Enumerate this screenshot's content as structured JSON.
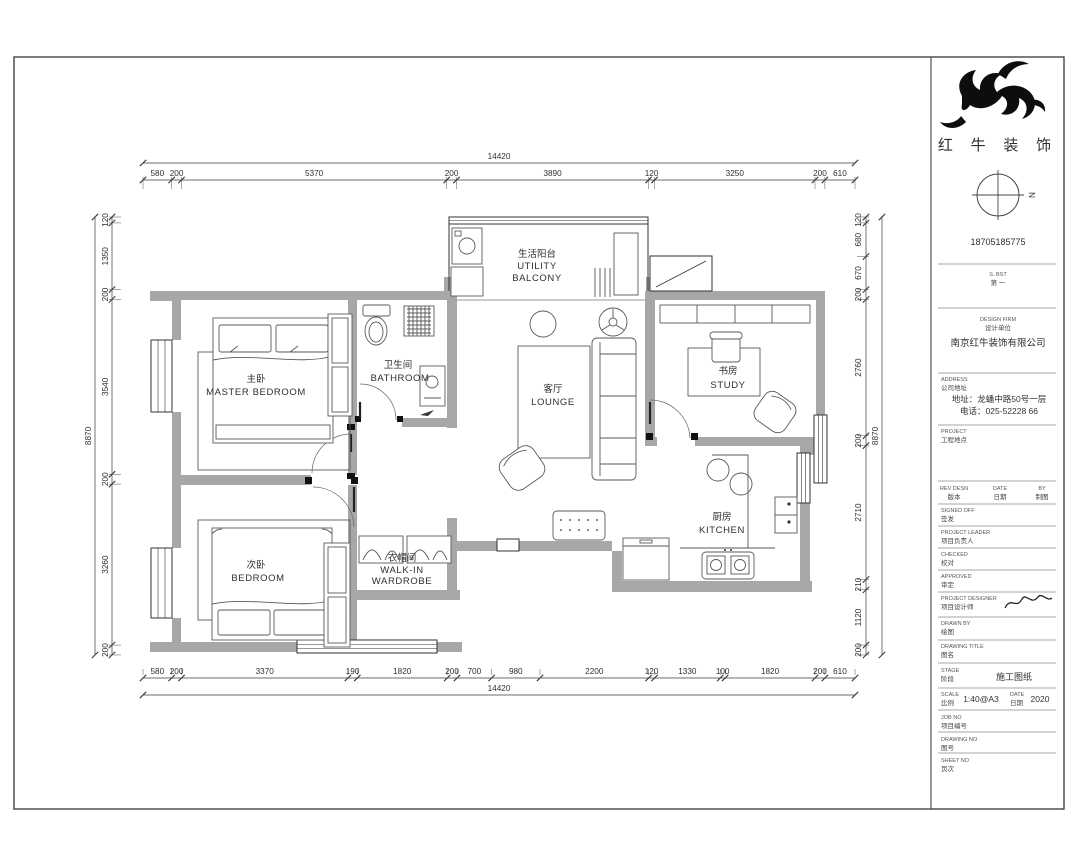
{
  "rooms": {
    "master": {
      "zh": "主卧",
      "en": "MASTER  BEDROOM"
    },
    "bedroom": {
      "zh": "次卧",
      "en": "BEDROOM"
    },
    "bathroom": {
      "zh": "卫生间",
      "en": "BATHROOM"
    },
    "wardrobe": {
      "zh": "衣帽间",
      "en": "WALK-IN",
      "en2": "WARDROBE"
    },
    "lounge": {
      "zh": "客厅",
      "en": "LOUNGE"
    },
    "balcony": {
      "zh": "生活阳台",
      "en": "UTILITY",
      "en2": "BALCONY"
    },
    "study": {
      "zh": "书房",
      "en": "STUDY"
    },
    "kitchen": {
      "zh": "厨房",
      "en": "KITCHEN"
    }
  },
  "dimensions": {
    "top": {
      "total": 14420,
      "segments": [
        580,
        200,
        5370,
        200,
        3890,
        120,
        3250,
        200,
        610
      ]
    },
    "bottom": {
      "total": 14420,
      "segments": [
        580,
        200,
        3370,
        190,
        1820,
        200,
        700,
        980,
        2200,
        120,
        1330,
        100,
        1820,
        200,
        610
      ]
    },
    "left": {
      "total": 8870,
      "segments": [
        120,
        1350,
        200,
        3540,
        200,
        3260,
        200
      ]
    },
    "right": {
      "total": 8870,
      "segments": [
        120,
        680,
        670,
        200,
        2760,
        200,
        2710,
        210,
        1120,
        200
      ]
    }
  },
  "title_block": {
    "brand": "红 牛 装 饰",
    "north": "N",
    "phone": "18705185775",
    "note_en": "S. BST",
    "note_zh": "第 一",
    "firm_label_en": "DESIGN FIRM",
    "firm_label_zh": "设计单位",
    "firm_name": "南京红牛装饰有限公司",
    "address_label_en": "ADDRESS",
    "address_label_zh": "公司地址",
    "address_line1": "地址：龙蟠中路50号一层",
    "address_line2": "电话：025-52228 66",
    "site_label_en": "PROJECT",
    "site_label_zh": "工程地点",
    "rev_cols": [
      {
        "en": "REV DESN",
        "zh": "版本"
      },
      {
        "en": "DATE",
        "zh": "日期"
      },
      {
        "en": "BY",
        "zh": "制图"
      }
    ],
    "rows": [
      {
        "en": "SIGNED OFF",
        "zh": "签发"
      },
      {
        "en": "PROJECT LEADER",
        "zh": "项目负责人"
      },
      {
        "en": "CHECKED",
        "zh": "校对"
      },
      {
        "en": "APPROVED",
        "zh": "审定"
      },
      {
        "en": "PROJECT DESIGNER",
        "zh": "项目设计师"
      },
      {
        "en": "DRAWN BY",
        "zh": "绘图"
      },
      {
        "en": "DRAWING TITLE",
        "zh": "图名"
      }
    ],
    "stage_label_en": "STAGE",
    "stage_label_zh": "阶段",
    "stage_value": "施工图纸",
    "scale_label_en": "SCALE",
    "scale_label_zh": "比例",
    "scale_value": "1:40@A3",
    "date_label_en": "DATE",
    "date_label_zh": "日期",
    "date_value": "2020",
    "job_label_en": "JOB NO",
    "job_label_zh": "项目编号",
    "dwg_label_en": "DRAWING NO",
    "dwg_label_zh": "图号",
    "sheet_label_en": "SHEET NO",
    "sheet_label_zh": "页次"
  }
}
